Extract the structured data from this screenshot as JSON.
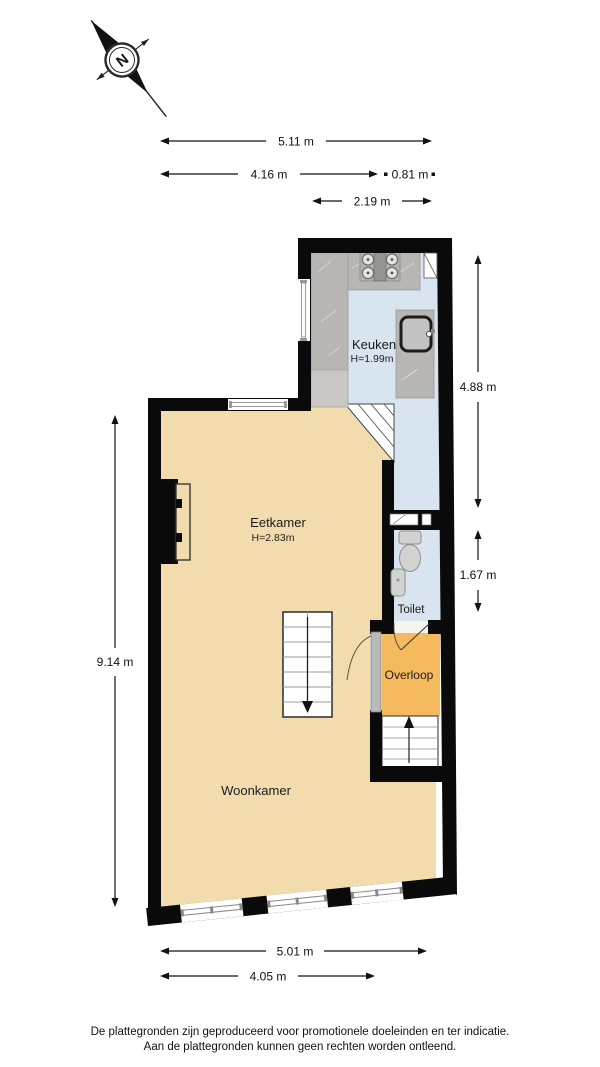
{
  "compass": {
    "label": "N"
  },
  "rooms": [
    {
      "id": "keuken",
      "name": "Keuken",
      "height": "H=1.99m"
    },
    {
      "id": "eetkamer",
      "name": "Eetkamer",
      "height": "H=2.83m"
    },
    {
      "id": "toilet",
      "name": "Toilet",
      "height": ""
    },
    {
      "id": "overloop",
      "name": "Overloop",
      "height": ""
    },
    {
      "id": "woonkamer",
      "name": "Woonkamer",
      "height": ""
    }
  ],
  "dimensions": {
    "top": [
      {
        "label": "5.11 m"
      },
      {
        "label": "4.16 m"
      },
      {
        "label": "0.81 m"
      },
      {
        "label": "2.19 m"
      }
    ],
    "left": [
      {
        "label": "9.14 m"
      }
    ],
    "right": [
      {
        "label": "4.88 m"
      },
      {
        "label": "1.67 m"
      }
    ],
    "bottom": [
      {
        "label": "5.01 m"
      },
      {
        "label": "4.05 m"
      }
    ]
  },
  "fixtures": [
    "stove",
    "kitchen-sink",
    "toilet",
    "washbasin",
    "fireplace",
    "stairs-down",
    "stairs-up"
  ],
  "colors": {
    "wall": "#0a0a0a",
    "living_floor": "#f2dcae",
    "kitchen_floor": "#d9e4f1",
    "landing_floor": "#f6ba5e",
    "counter": "#b7b6b3",
    "appliance": "#c9c8c6"
  },
  "footer": {
    "line1": "De plattegronden zijn geproduceerd voor promotionele doeleinden en ter indicatie.",
    "line2": "Aan de plattegronden kunnen geen rechten worden ontleend."
  }
}
